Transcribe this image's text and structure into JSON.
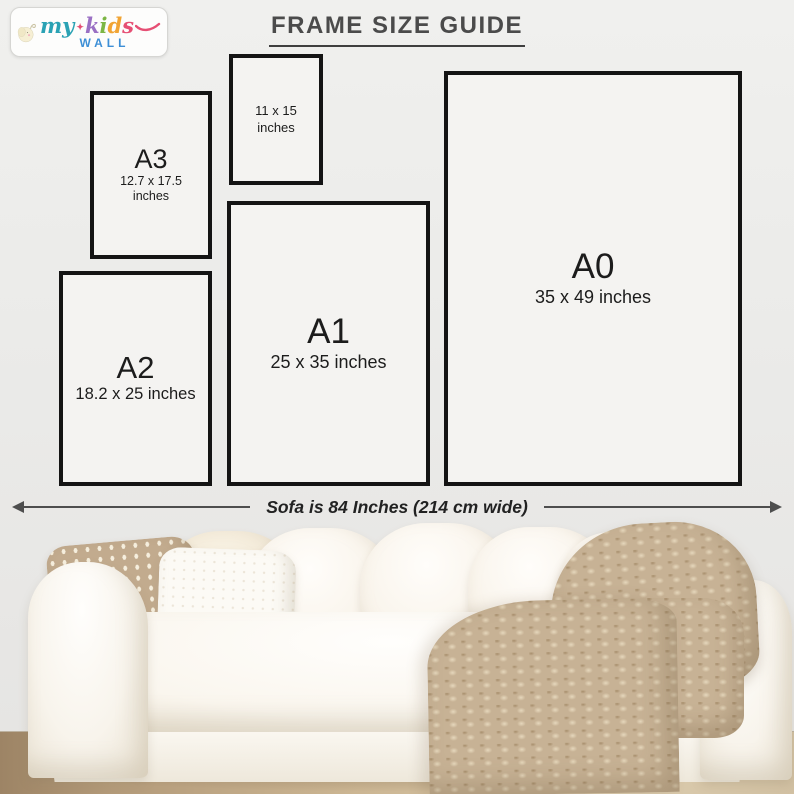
{
  "brand": {
    "word_my": "my",
    "sparkle": "✦",
    "word_kids_letters": [
      "k",
      "i",
      "d",
      "s"
    ],
    "word_wall": "WALL",
    "colors": {
      "my": "#2aa2b4",
      "k": "#9a70c4",
      "i": "#7cb644",
      "d": "#f1a433",
      "s": "#e64f74",
      "swash": "#e64f74",
      "wall_word": "#3d8fd6",
      "elephant": "#f6efd4"
    }
  },
  "header": {
    "title": "FRAME SIZE GUIDE"
  },
  "frames": [
    {
      "key": "A3",
      "label": "A3",
      "size_line1": "12.7 x 17.5",
      "size_line2": "inches"
    },
    {
      "key": "11x15",
      "label": "",
      "size_line1": "11 x 15",
      "size_line2": "inches"
    },
    {
      "key": "A2",
      "label": "A2",
      "size_line1": "18.2 x 25 inches",
      "size_line2": ""
    },
    {
      "key": "A1",
      "label": "A1",
      "size_line1": "25 x 35 inches",
      "size_line2": ""
    },
    {
      "key": "A0",
      "label": "A0",
      "size_line1": "35 x 49 inches",
      "size_line2": ""
    }
  ],
  "sofa": {
    "width_label": "Sofa is 84 Inches (214 cm wide)"
  },
  "palette": {
    "wall": "#ebebe9",
    "frame_border": "#141414",
    "frame_fill": "#f4f3f1",
    "title_color": "#4b4b4b",
    "arrow_color": "#4e4e4e",
    "floor_wood_dark": "#9d8465",
    "floor_wood_light": "#dbcbad",
    "sofa_white": "#faf6ee",
    "patterned_pillow": "#c2ab8e",
    "knit_blanket": "#c7b295"
  }
}
